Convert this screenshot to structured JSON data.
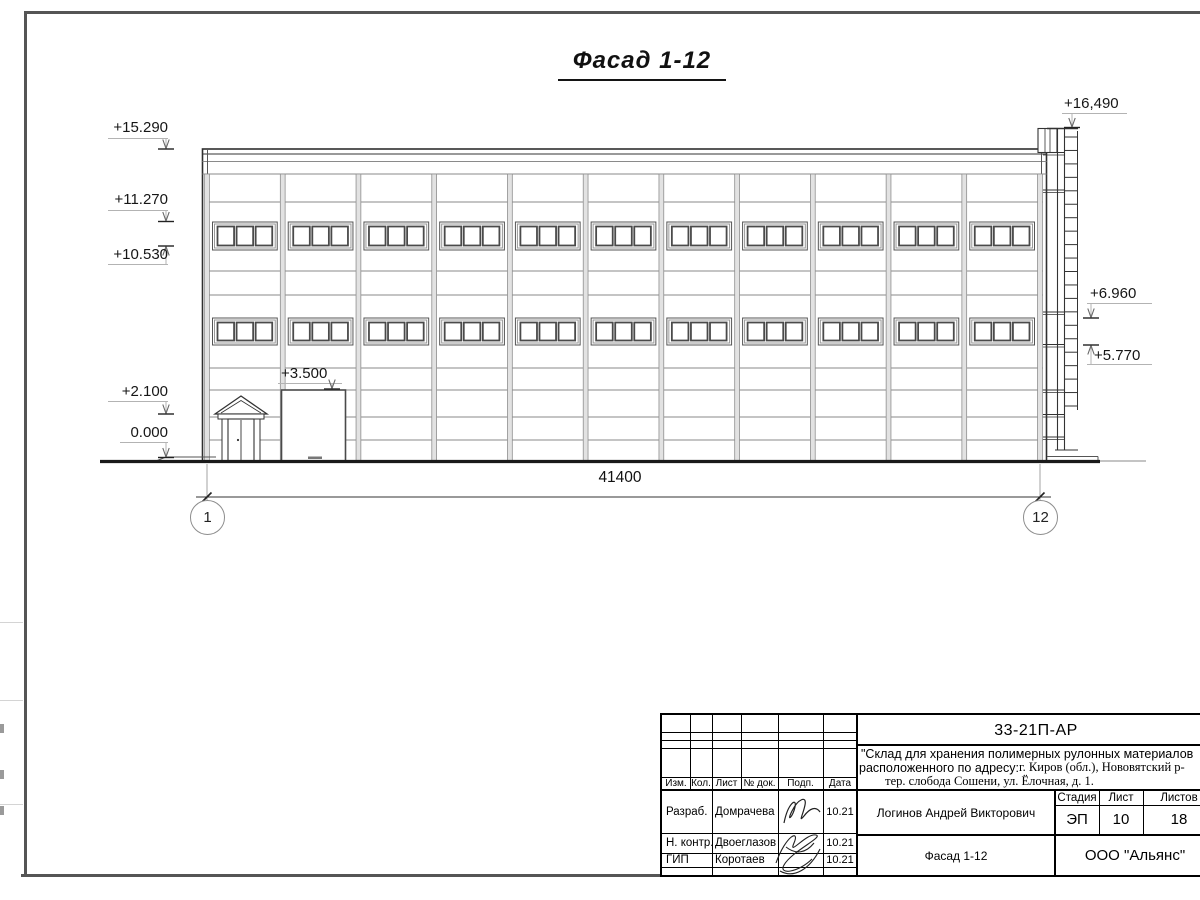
{
  "page": {
    "title": "Фасад 1-12"
  },
  "marks": {
    "left": [
      "+15.290",
      "+11.270",
      "+10.530",
      "+2.100",
      "0.000"
    ],
    "right": [
      "+16,490",
      "+6.960",
      "+5.770"
    ],
    "gate": "+3.500"
  },
  "dimension": {
    "total": "41400"
  },
  "grid": {
    "start": "1",
    "end": "12"
  },
  "title_block": {
    "doc_code": "33-21П-АР",
    "project_line1": "\"Склад для хранения полимерных рулонных материалов",
    "project_line2_sans": "расположенного по адресу:",
    "project_line2_serif": " г. Киров (обл.), Нововятский р-",
    "project_line3": "тер. слобода Сошени, ул. Ёлочная, д. 1.",
    "cols": [
      "Изм.",
      "Кол.",
      "Лист",
      "№ док.",
      "Подп.",
      "Дата"
    ],
    "rows": [
      {
        "role": "Разраб.",
        "name": "Домрачева",
        "date": "10.21"
      },
      {
        "role": "Н. контр.",
        "name": "Двоеглазов",
        "date": "10.21"
      },
      {
        "role": "ГИП",
        "name": "Коротаев",
        "date": "10.21"
      }
    ],
    "chief_name": "Логинов Андрей Викторович",
    "stage_label": "Стадия",
    "sheet_label": "Лист",
    "sheets_label": "Листов",
    "stage": "ЭП",
    "sheet": "10",
    "sheets": "18",
    "drawing_name": "Фасад 1-12",
    "company": "ООО \"Альянс\""
  }
}
